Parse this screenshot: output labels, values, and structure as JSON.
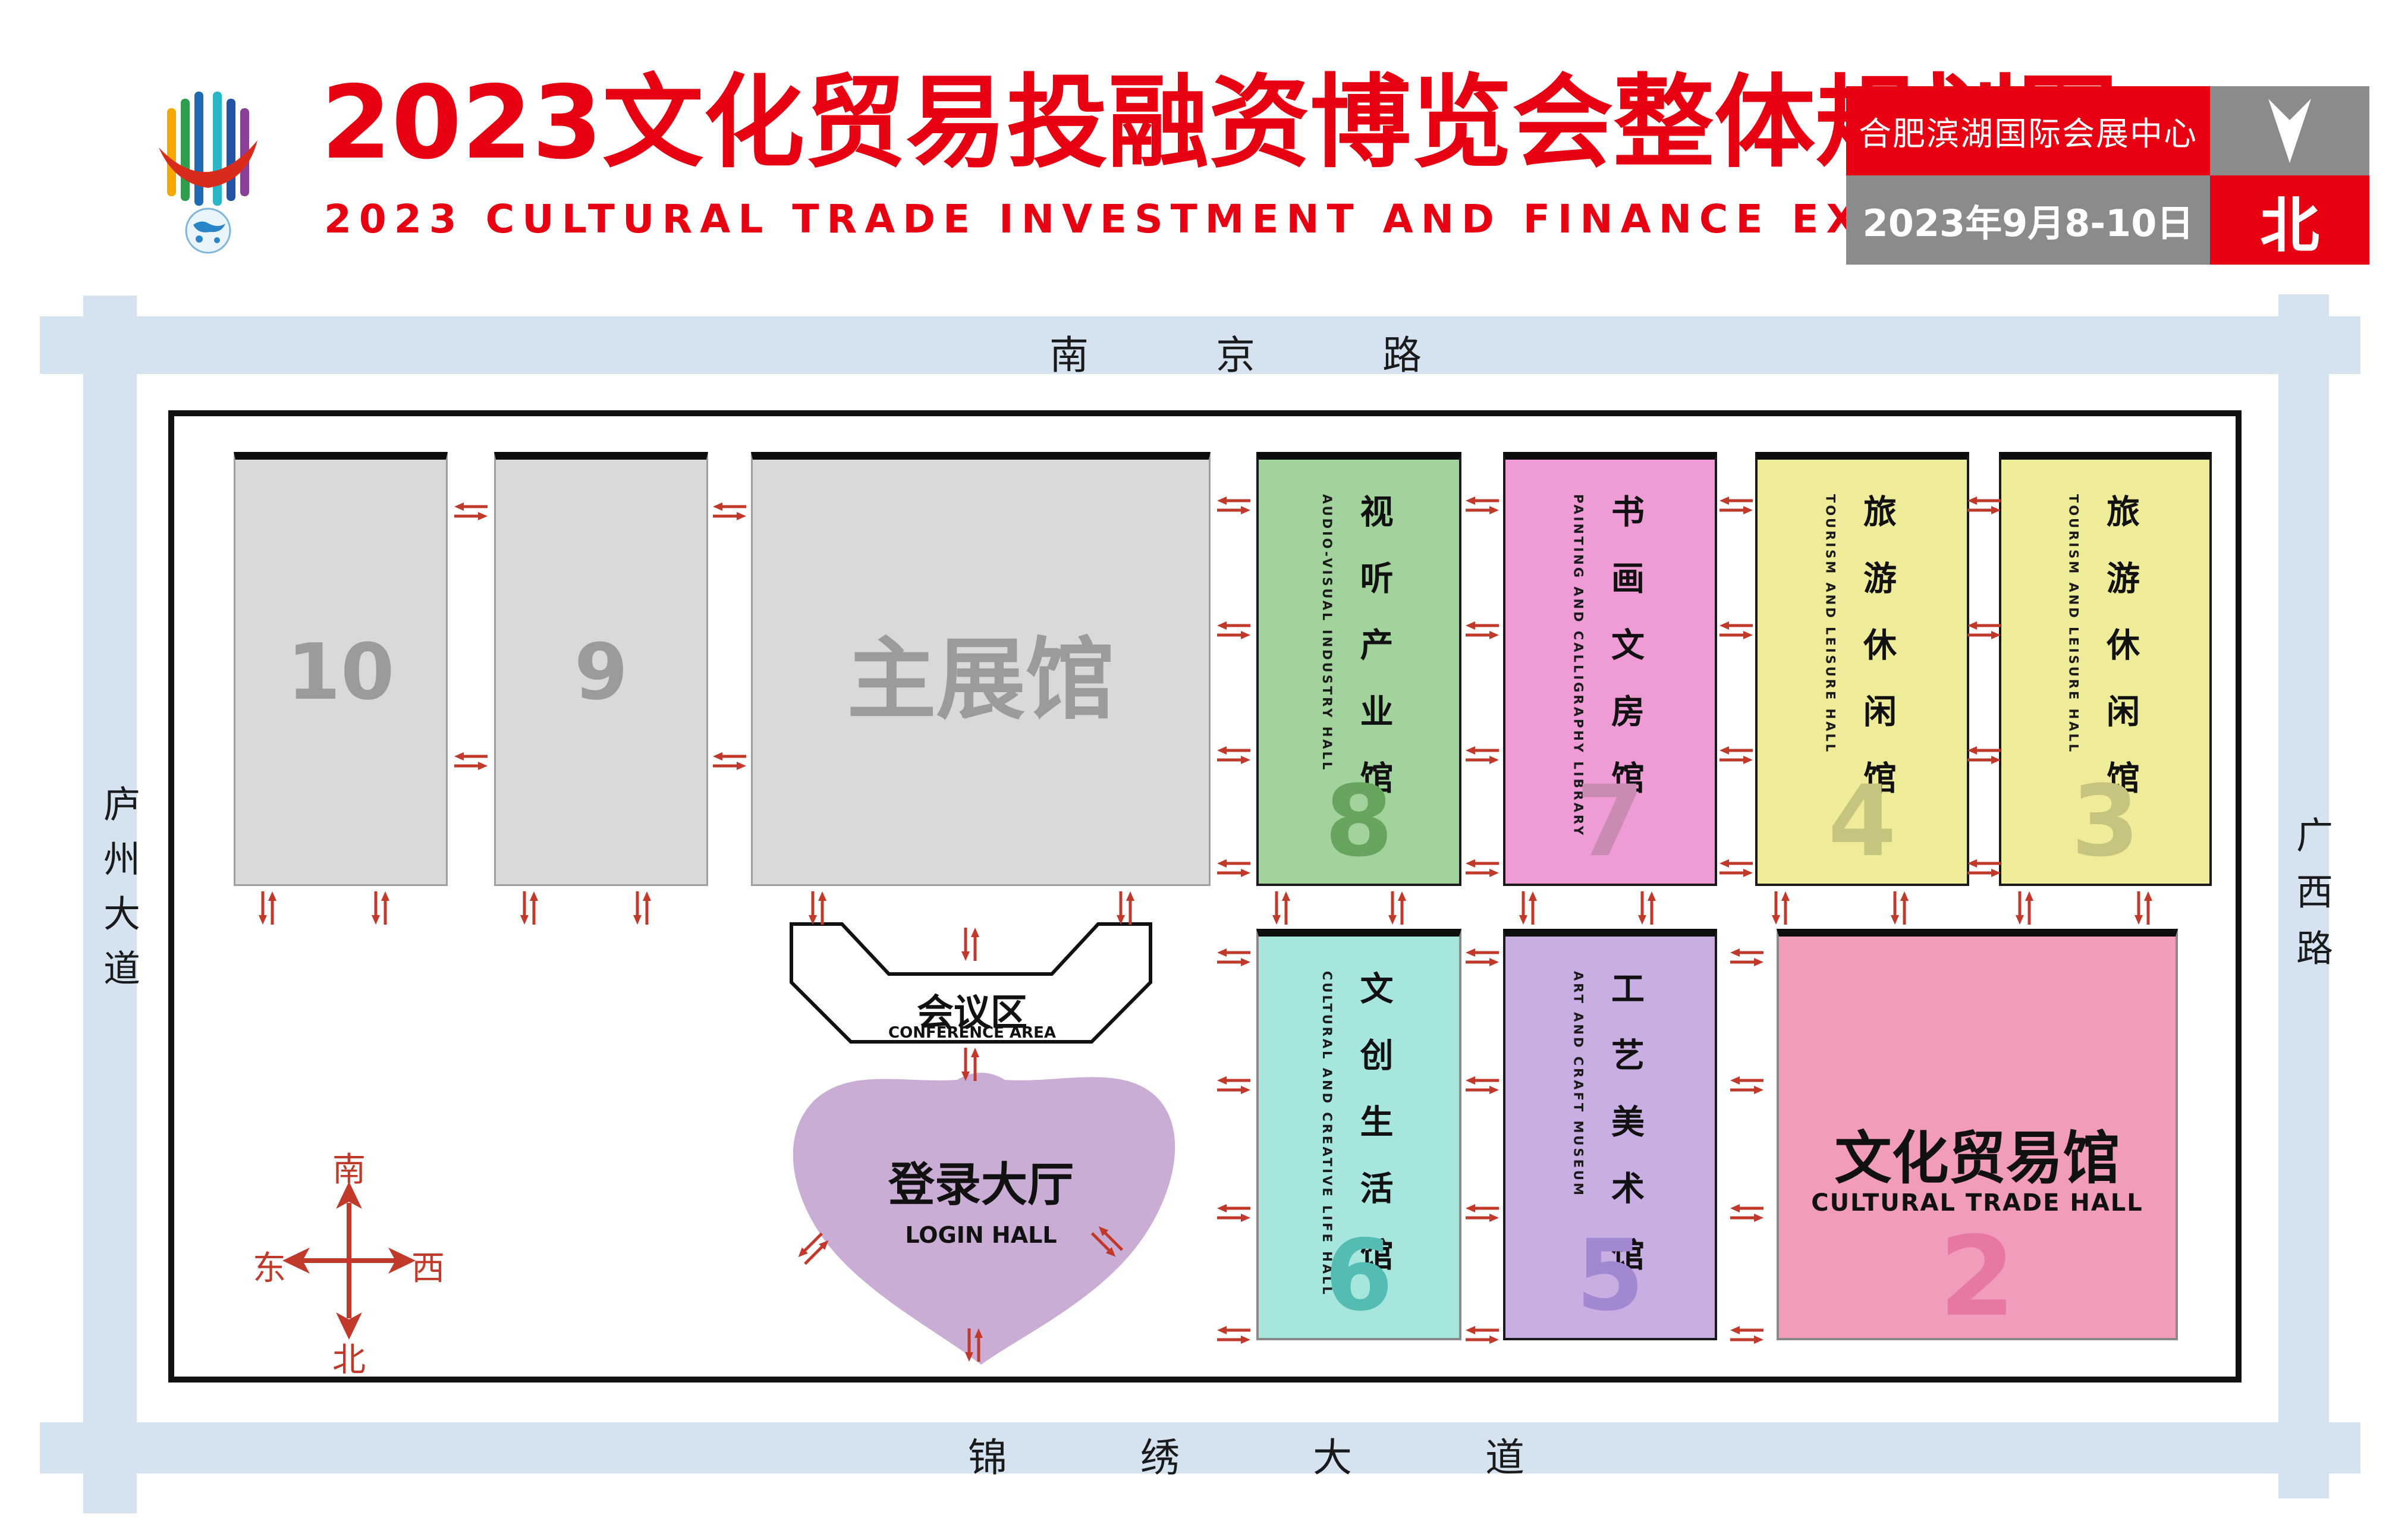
{
  "header": {
    "title_cn": "2023文化贸易投融资博览会整体规划图",
    "title_en": "2023 CULTURAL TRADE INVESTMENT AND FINANCE EXPO",
    "venue": "合肥滨湖国际会展中心",
    "dates": "2023年9月8-10日",
    "north_label": "北"
  },
  "roads": {
    "top": "南京路",
    "bottom": "锦绣大道",
    "left": "庐州大道",
    "right": "广西路"
  },
  "compass": {
    "top": "南",
    "bottom": "北",
    "left": "东",
    "right": "西"
  },
  "halls": [
    {
      "id": "10",
      "label": "10"
    },
    {
      "id": "9",
      "label": "9"
    },
    {
      "id": "main",
      "label": "主展馆"
    },
    {
      "id": "8",
      "number": "8",
      "name_cn": "视听产业馆",
      "name_en": "AUDIO-VISUAL INDUSTRY HALL"
    },
    {
      "id": "7",
      "number": "7",
      "name_cn": "书画文房馆",
      "name_en": "PAINTING AND CALLIGRAPHY LIBRARY"
    },
    {
      "id": "4",
      "number": "4",
      "name_cn": "旅游休闲馆",
      "name_en": "TOURISM AND LEISURE HALL"
    },
    {
      "id": "3",
      "number": "3",
      "name_cn": "旅游休闲馆",
      "name_en": "TOURISM AND LEISURE HALL"
    },
    {
      "id": "6",
      "number": "6",
      "name_cn": "文创生活馆",
      "name_en": "CULTURAL AND CREATIVE LIFE HALL"
    },
    {
      "id": "5",
      "number": "5",
      "name_cn": "工艺美术馆",
      "name_en": "ART AND CRAFT MUSEUM"
    },
    {
      "id": "2",
      "number": "2",
      "name_cn": "文化贸易馆",
      "name_en": "CULTURAL TRADE HALL"
    }
  ],
  "areas": {
    "conference_cn": "会议区",
    "conference_en": "CONFERENCE AREA",
    "login_cn": "登录大厅",
    "login_en": "LOGIN HALL"
  },
  "colors": {
    "brand_red": "#e60012",
    "road_blue": "#d5e3f1",
    "hall_gray": "#d9d9d9",
    "hall_8_green": "#a2d39c",
    "hall_7_pink": "#ef9cd6",
    "hall_4_3_yellow": "#eeeb99",
    "hall_6_cyan": "#a7e6de",
    "hall_5_purple": "#c8aee3",
    "hall_2_pink": "#f19cba",
    "login_purple": "#c9add4",
    "arrow_red": "#c0392b"
  }
}
